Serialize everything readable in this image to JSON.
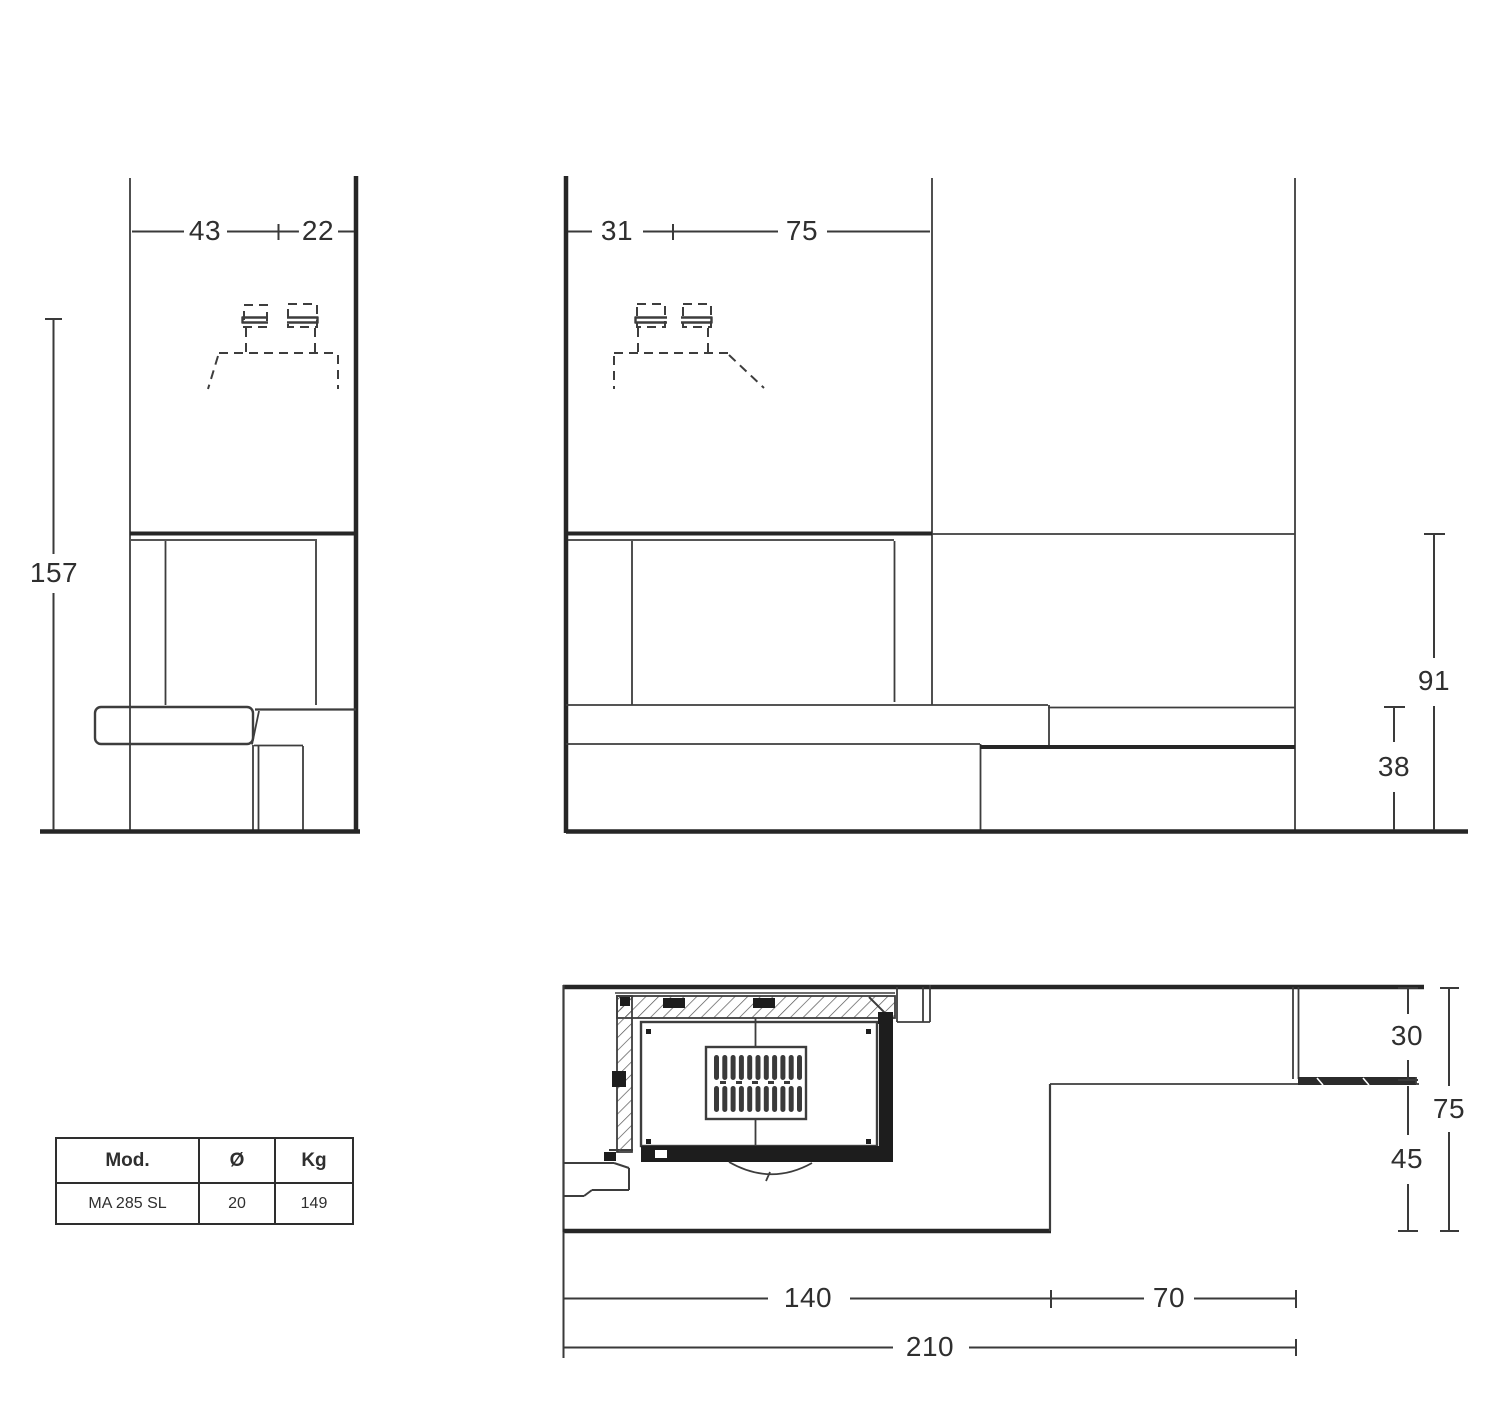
{
  "views": {
    "front": {
      "dims": {
        "width_left": "43",
        "width_right": "22",
        "height": "157"
      }
    },
    "side": {
      "dims": {
        "depth_left": "31",
        "depth_right": "75",
        "lintel_height": "91",
        "bench_height": "38"
      }
    },
    "plan": {
      "dims": {
        "wall_depth": "30",
        "hearth_front_depth": "45",
        "total_depth": "75",
        "width_main": "140",
        "width_side": "70",
        "width_total": "210"
      }
    }
  },
  "table": {
    "headers": [
      "Mod.",
      "Ø",
      "Kg"
    ],
    "rows": [
      [
        "MA 285 SL",
        "20",
        "149"
      ]
    ]
  },
  "colors": {
    "line_thin": "#3d3d3d",
    "line_thick": "#262626",
    "fill_dark": "#1d1d1d"
  }
}
